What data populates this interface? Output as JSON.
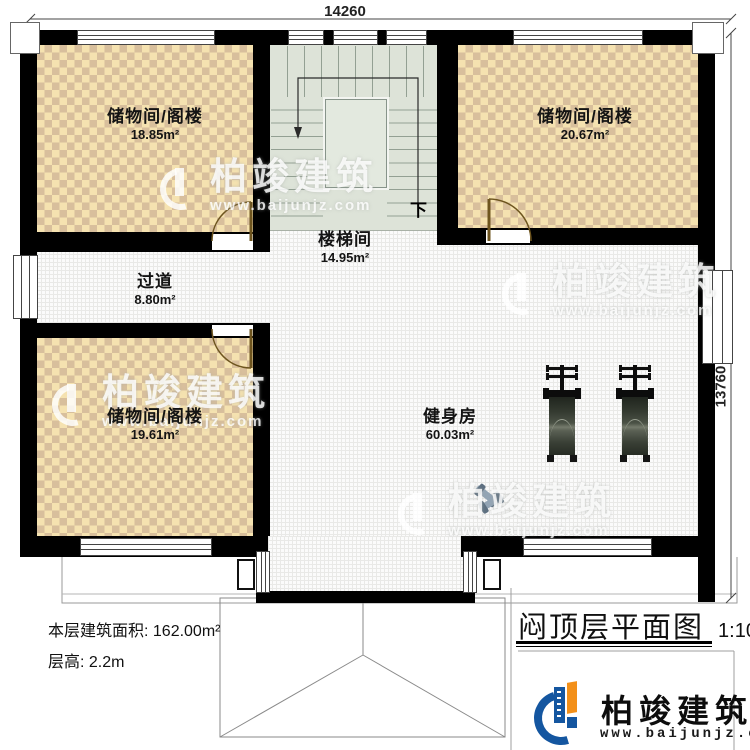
{
  "plan": {
    "title": "闷顶层平面图",
    "scale": "1:100",
    "dimensions": {
      "top": "14260",
      "right": "13760"
    },
    "stair_down": "下",
    "rooms": {
      "storage_top_left": {
        "name": "储物间/阁楼",
        "area": "18.85m²"
      },
      "storage_top_right": {
        "name": "储物间/阁楼",
        "area": "20.67m²"
      },
      "stairwell": {
        "name": "楼梯间",
        "area": "14.95m²"
      },
      "hallway": {
        "name": "过道",
        "area": "8.80m²"
      },
      "storage_bottom_left": {
        "name": "储物间/阁楼",
        "area": "19.61m²"
      },
      "gym": {
        "name": "健身房",
        "area": "60.03m²"
      }
    },
    "notes": {
      "floor_area": "本层建筑面积: 162.00m²",
      "floor_height": "层高: 2.2m"
    }
  },
  "branding": {
    "company": "柏竣建筑",
    "website": "www.baijunjz.com"
  },
  "watermark": {
    "company": "柏竣建筑",
    "website": "www.baijunjz.com"
  },
  "colors": {
    "checker_light": "#f5e2b0",
    "checker_dark": "#d8bf9c",
    "stair_floor": "#dde3d8",
    "floor_white": "#fbfbfb",
    "wall": "#000000",
    "logo_blue": "#1456a0",
    "logo_orange": "#f39019"
  }
}
